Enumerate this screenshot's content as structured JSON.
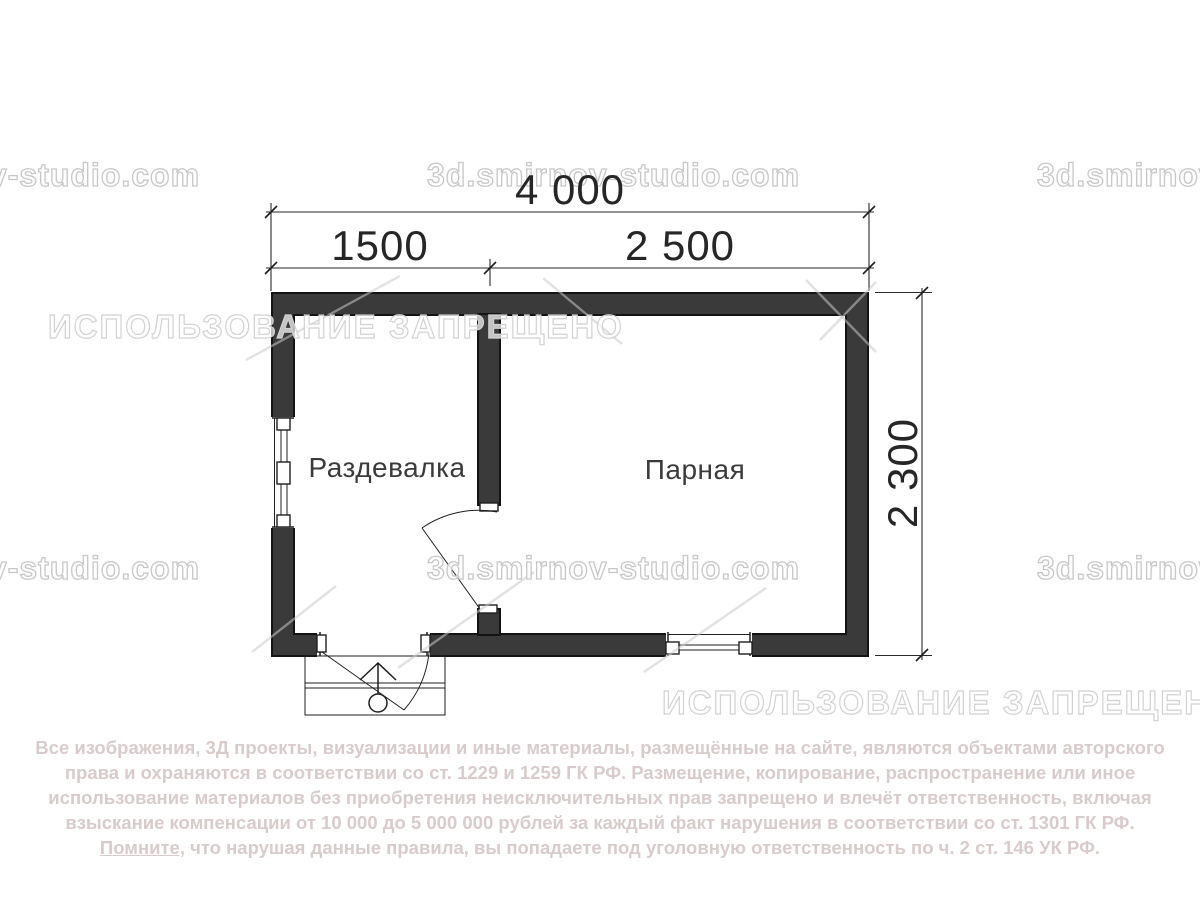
{
  "plan": {
    "rooms": [
      {
        "label": "Раздевалка"
      },
      {
        "label": "Парная"
      }
    ],
    "dimensions": {
      "total_width_mm": "4 000",
      "left_room_width_mm": "1500",
      "right_room_width_mm": "2 500",
      "depth_mm": "2 300"
    }
  },
  "watermarks": {
    "site_url": "3d.smirnov-studio.com",
    "usage_banned": "ИСПОЛЬЗОВАНИЕ ЗАПРЕЩЕНО"
  },
  "copyright": {
    "line1": "Все изображения, 3Д проекты, визуализации и иные материалы, размещённые на сайте, являются объектами авторского",
    "line2": "права и охраняются в соответствии со ст. 1229 и 1259 ГК РФ. Размещение, копирование, распространение или иное",
    "line3": "использование материалов без приобретения неисключительных прав запрещено и влечёт ответственность, включая",
    "line4": "взыскание компенсации от 10 000 до 5 000 000 рублей за каждый факт нарушения в соответствии со ст. 1301 ГК РФ.",
    "line5_underlined": "Помните,",
    "line5_rest": " что нарушая данные правила, вы попадаете под уголовную ответственность по ч. 2 ст. 146 УК РФ."
  },
  "colors": {
    "wall": "#3a3a3a",
    "line": "#1f1f1f",
    "dim": "#2a2a2a",
    "copy": "#d9cbcb"
  }
}
